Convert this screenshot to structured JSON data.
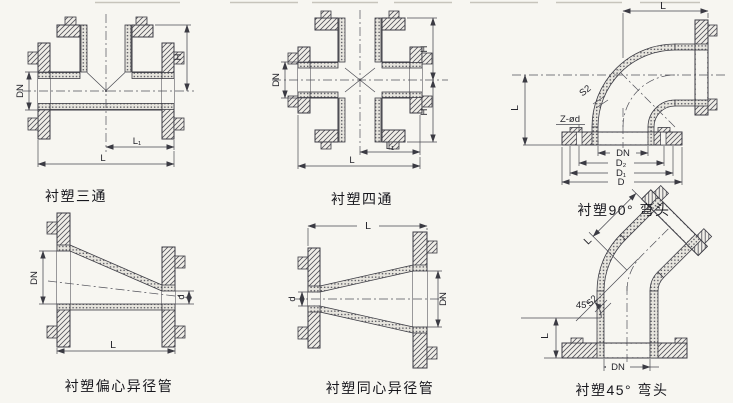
{
  "sheet": {
    "background_color": "#f7f6f1",
    "ink_color": "#3b3b43"
  },
  "figures": [
    {
      "id": "tee",
      "caption": "衬塑三通",
      "dims": {
        "dn": "DN",
        "h": "H",
        "l1": "L₁",
        "l": "L"
      }
    },
    {
      "id": "cross",
      "caption": "衬塑四通",
      "dims": {
        "dn": "DN",
        "h_top": "H",
        "h_bottom": "H",
        "l1": "L₁",
        "l": "L"
      }
    },
    {
      "id": "elbow-90",
      "caption": "衬塑90° 弯头",
      "dims": {
        "l_top": "L",
        "l_left": "L",
        "s2": "S2",
        "z_od": "Z-ød",
        "dn": "DN",
        "d2": "D₂",
        "d1": "D₁",
        "d": "D"
      }
    },
    {
      "id": "eccentric-reducer",
      "caption": "衬塑偏心异径管",
      "dims": {
        "dn": "DN",
        "d": "d",
        "l": "L"
      }
    },
    {
      "id": "concentric-reducer",
      "caption": "衬塑同心异径管",
      "dims": {
        "d": "d",
        "dn": "DN",
        "l": "L"
      }
    },
    {
      "id": "elbow-45",
      "caption": "衬塑45° 弯头",
      "dims": {
        "l_angled": "L",
        "angle": "45°",
        "s2": "S2",
        "l_left": "L",
        "dn": "DN"
      }
    }
  ]
}
